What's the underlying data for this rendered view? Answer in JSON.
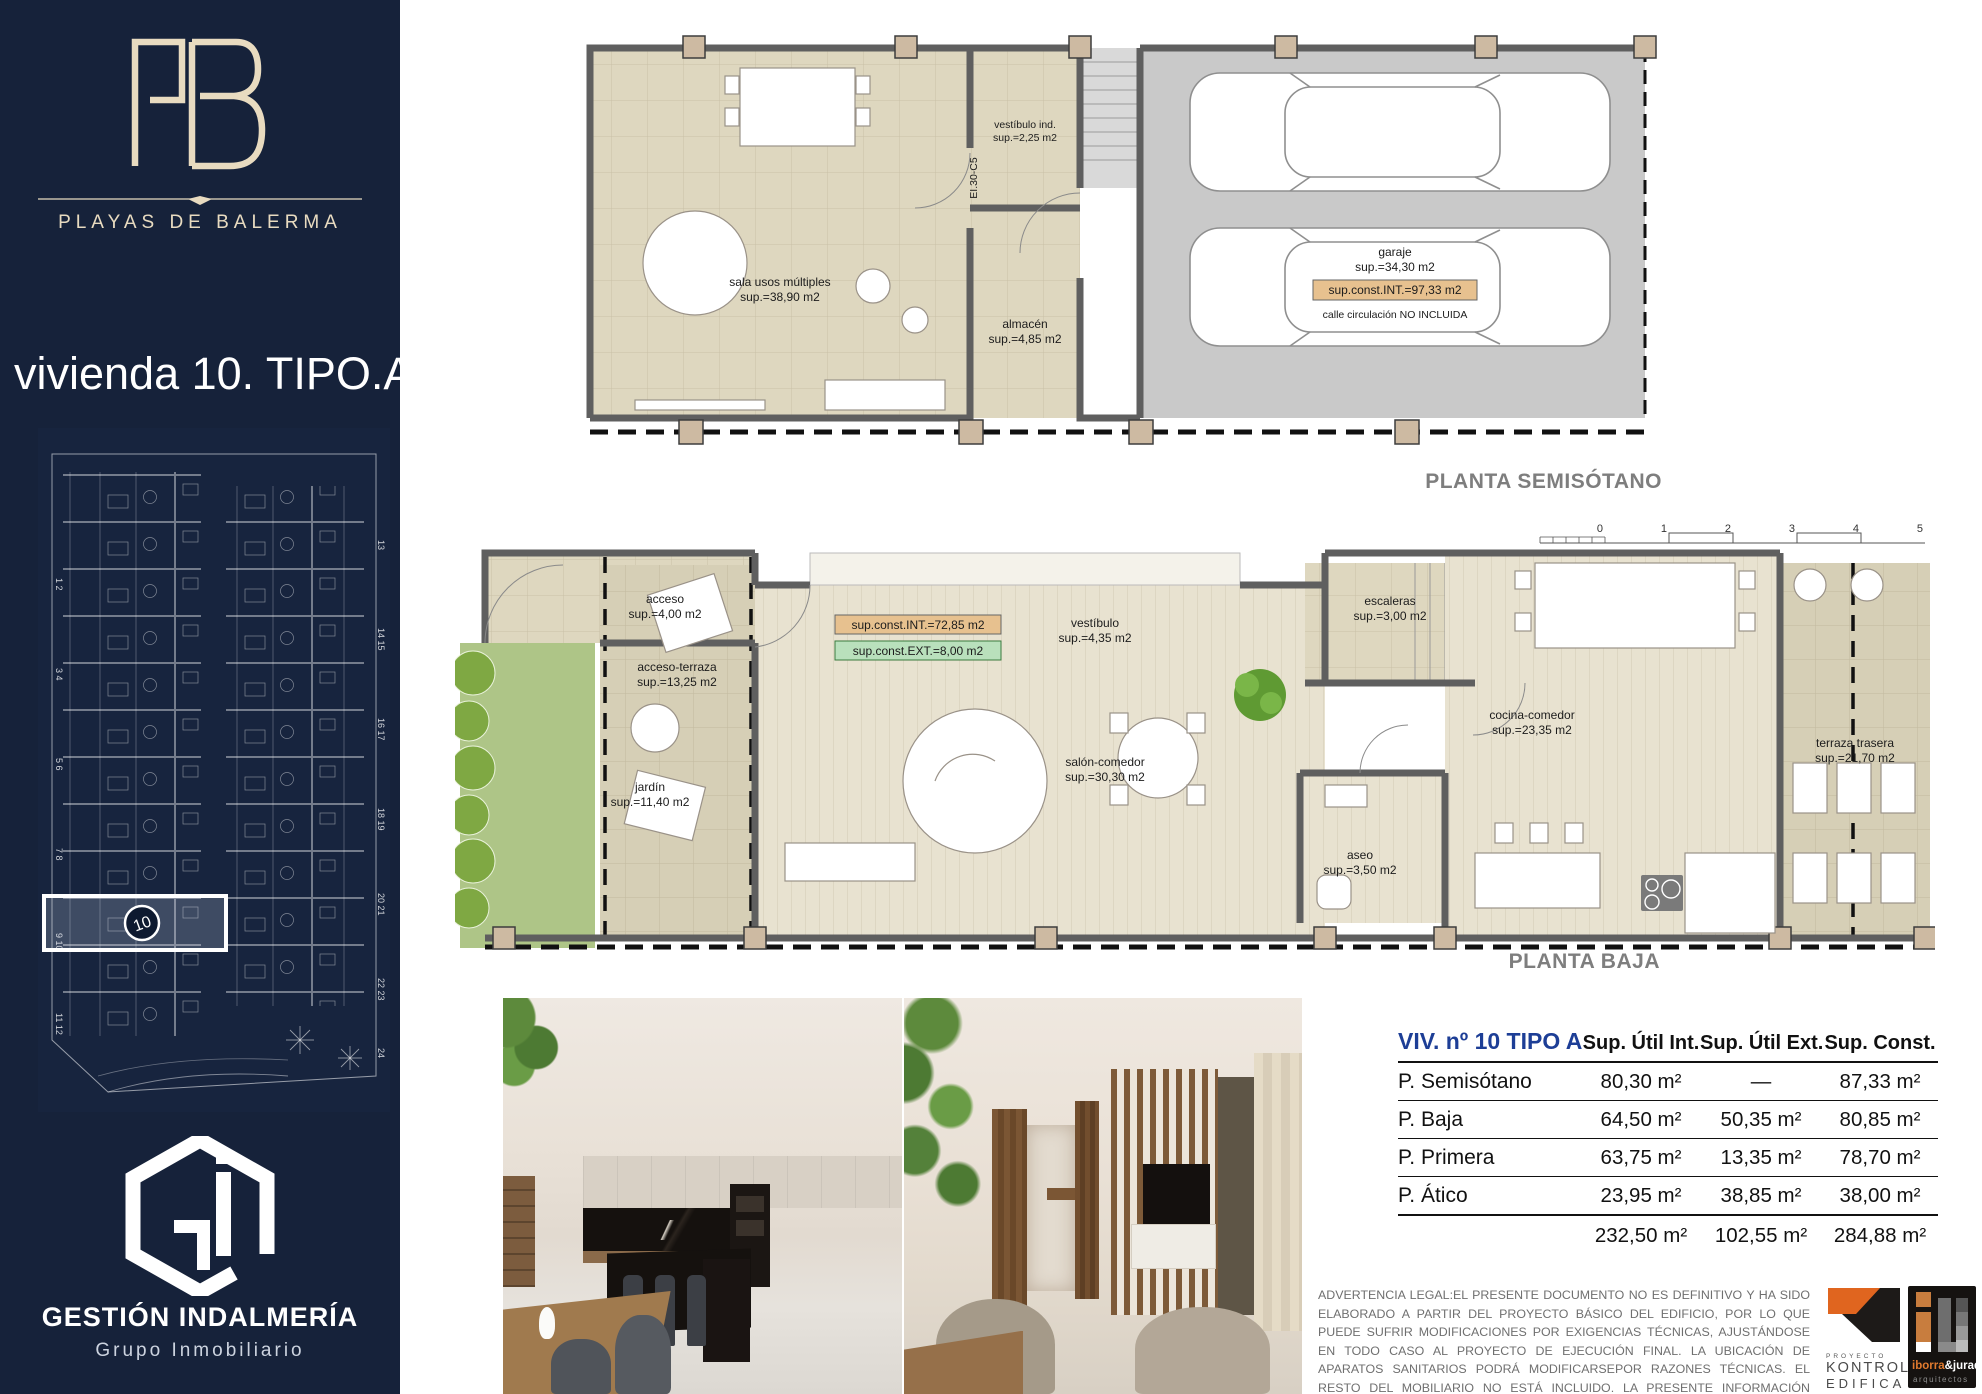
{
  "colors": {
    "sidebar_navy": "#16223a",
    "cream": "#e8dbc0",
    "table_blue": "#1d3e96",
    "kontrol_orange": "#e0651f",
    "plan_beige": "#ded7bf",
    "jardin_green": "#aec587"
  },
  "sidebar": {
    "brand_name": "PLAYAS DE BALERMA",
    "title": "vivienda 10. TIPO.A",
    "siteplan": {
      "left_numbers": [
        "1 2",
        "3 4",
        "5 6",
        "7 8",
        "9 10",
        "11 12"
      ],
      "right_numbers": [
        "13",
        "14 15",
        "16 17",
        "18 19",
        "20 21",
        "22 23",
        "24"
      ],
      "highlight_unit": "10"
    },
    "company": "GESTIÓN INDALMERÍA",
    "company_sub": "Grupo Inmobiliario"
  },
  "plans": {
    "semisotano": {
      "title": "PLANTA SEMISÓTANO",
      "sala_name": "sala usos múltiples",
      "sala_sup": "sup.=38,90 m2",
      "vest_name": "vestíbulo ind.",
      "vest_sup": "sup.=2,25 m2",
      "almacen_name": "almacén",
      "almacen_sup": "sup.=4,85 m2",
      "garaje_name": "garaje",
      "garaje_sup": "sup.=34,30 m2",
      "const_box": "sup.const.INT.=97,33 m2",
      "calle_note": "calle circulación NO INCLUIDA",
      "door_code": "EI.30-C5"
    },
    "baja": {
      "title": "PLANTA BAJA",
      "ruler_ticks": [
        "0",
        "1",
        "2",
        "3",
        "4",
        "5"
      ],
      "acceso_name": "acceso",
      "acceso_sup": "sup.=4,00 m2",
      "terraza_acc_name": "acceso-terraza",
      "terraza_acc_sup": "sup.=13,25 m2",
      "jardin_name": "jardín",
      "jardin_sup": "sup.=11,40 m2",
      "vestibulo_name": "vestíbulo",
      "vestibulo_sup": "sup.=4,35 m2",
      "escaleras_name": "escaleras",
      "escaleras_sup": "sup.=3,00 m2",
      "salon_name": "salón-comedor",
      "salon_sup": "sup.=30,30 m2",
      "cocina_name": "cocina-comedor",
      "cocina_sup": "sup.=23,35 m2",
      "aseo_name": "aseo",
      "aseo_sup": "sup.=3,50 m2",
      "terraza_tras_name": "terraza trasera",
      "terraza_tras_sup": "sup.=21,70 m2",
      "const_int_box": "sup.const.INT.=72,85 m2",
      "const_ext_box": "sup.const.EXT.=8,00 m2"
    }
  },
  "table": {
    "title": "VIV. nº 10  TIPO A",
    "columns": [
      "Sup. Útil Int.",
      "Sup. Útil Ext.",
      "Sup. Const."
    ],
    "rows": [
      {
        "label": "P. Semisótano",
        "int": "80,30 m²",
        "ext": "—",
        "const": "87,33 m²"
      },
      {
        "label": "P. Baja",
        "int": "64,50 m²",
        "ext": "50,35 m²",
        "const": "80,85 m²"
      },
      {
        "label": "P. Primera",
        "int": "63,75 m²",
        "ext": "13,35 m²",
        "const": "78,70 m²"
      },
      {
        "label": "P. Ático",
        "int": "23,95 m²",
        "ext": "38,85 m²",
        "const": "38,00 m²"
      }
    ],
    "totals": {
      "int": "232,50 m²",
      "ext": "102,55 m²",
      "const": "284,88 m²"
    }
  },
  "legal": "ADVERTENCIA LEGAL:EL PRESENTE DOCUMENTO NO ES DEFINITIVO Y HA SIDO ELABORADO A PARTIR DEL PROYECTO BÁSICO DEL EDIFICIO, POR LO QUE PUEDE SUFRIR MODIFICACIONES POR EXIGENCIAS TÉCNICAS, AJUSTÁNDOSE EN TODO CASO AL PROYECTO DE EJECUCIÓN FINAL. LA UBICACIÓN DE APARATOS SANITARIOS PODRÁ MODIFICARSEPOR RAZONES TÉCNICAS. EL RESTO DEL MOBILIARIO NO ESTÁ INCLUIDO. LA PRESENTE INFORMACIÓN COMERCIAL NO TIENE VALOR CONTRACTUAL. TODA LA INFORMACIÓN REFERIDA EN EL RD 515/89 DE 21 DE ABRIL SE ENCUENTRA A SU DISPOSICIÓN EN NUESTRAS OFICINAS.",
  "logos": {
    "kontrol": {
      "word1": "PROYECTO",
      "word2": "KONTROL",
      "word3": "EDIFICA"
    },
    "iborra": {
      "part1": "iborra",
      "part2": "&jurado",
      "sub": "arquitectos"
    }
  }
}
